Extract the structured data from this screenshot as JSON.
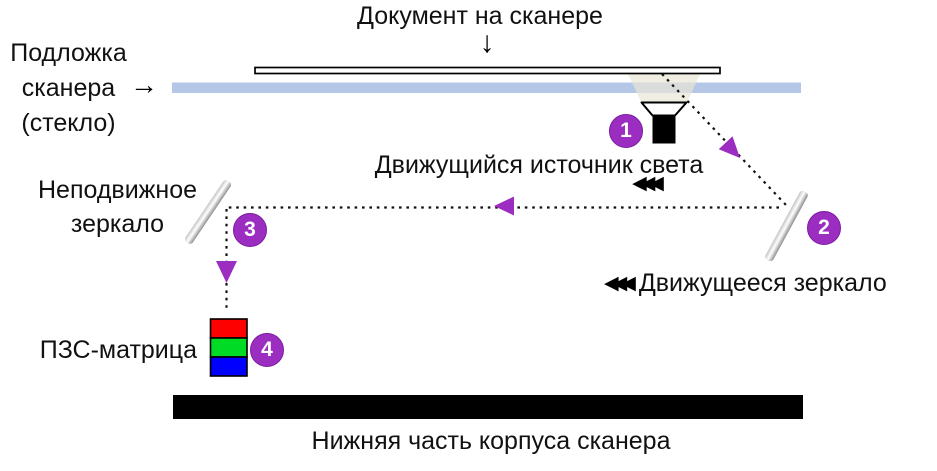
{
  "title": "Документ на сканере",
  "labels": {
    "glass": [
      "Подложка",
      "сканера",
      "(стекло)"
    ],
    "light_source": "Движущийся источник света",
    "fixed_mirror": [
      "Неподвижное",
      "зеркало"
    ],
    "moving_mirror": "Движущееся зеркало",
    "ccd": "ПЗС-матрица",
    "bottom_case": "Нижняя часть корпуса сканера"
  },
  "markers": [
    "1",
    "2",
    "3",
    "4"
  ],
  "icons": {
    "document_pointer": "↓",
    "glass_pointer": "→",
    "light_motion_arrows": "◀◀◀",
    "mirror_motion_arrows": "◀◀◀"
  },
  "colors": {
    "accent_purple": "#9B2EC1",
    "glass_blue": "#B4C7E7",
    "light_beam": "#E9E6D6",
    "case_black": "#000000"
  },
  "ccd_cells": [
    {
      "name": "red",
      "color": "#FF0000"
    },
    {
      "name": "green",
      "color": "#00DC26"
    },
    {
      "name": "blue",
      "color": "#0000FF"
    }
  ]
}
